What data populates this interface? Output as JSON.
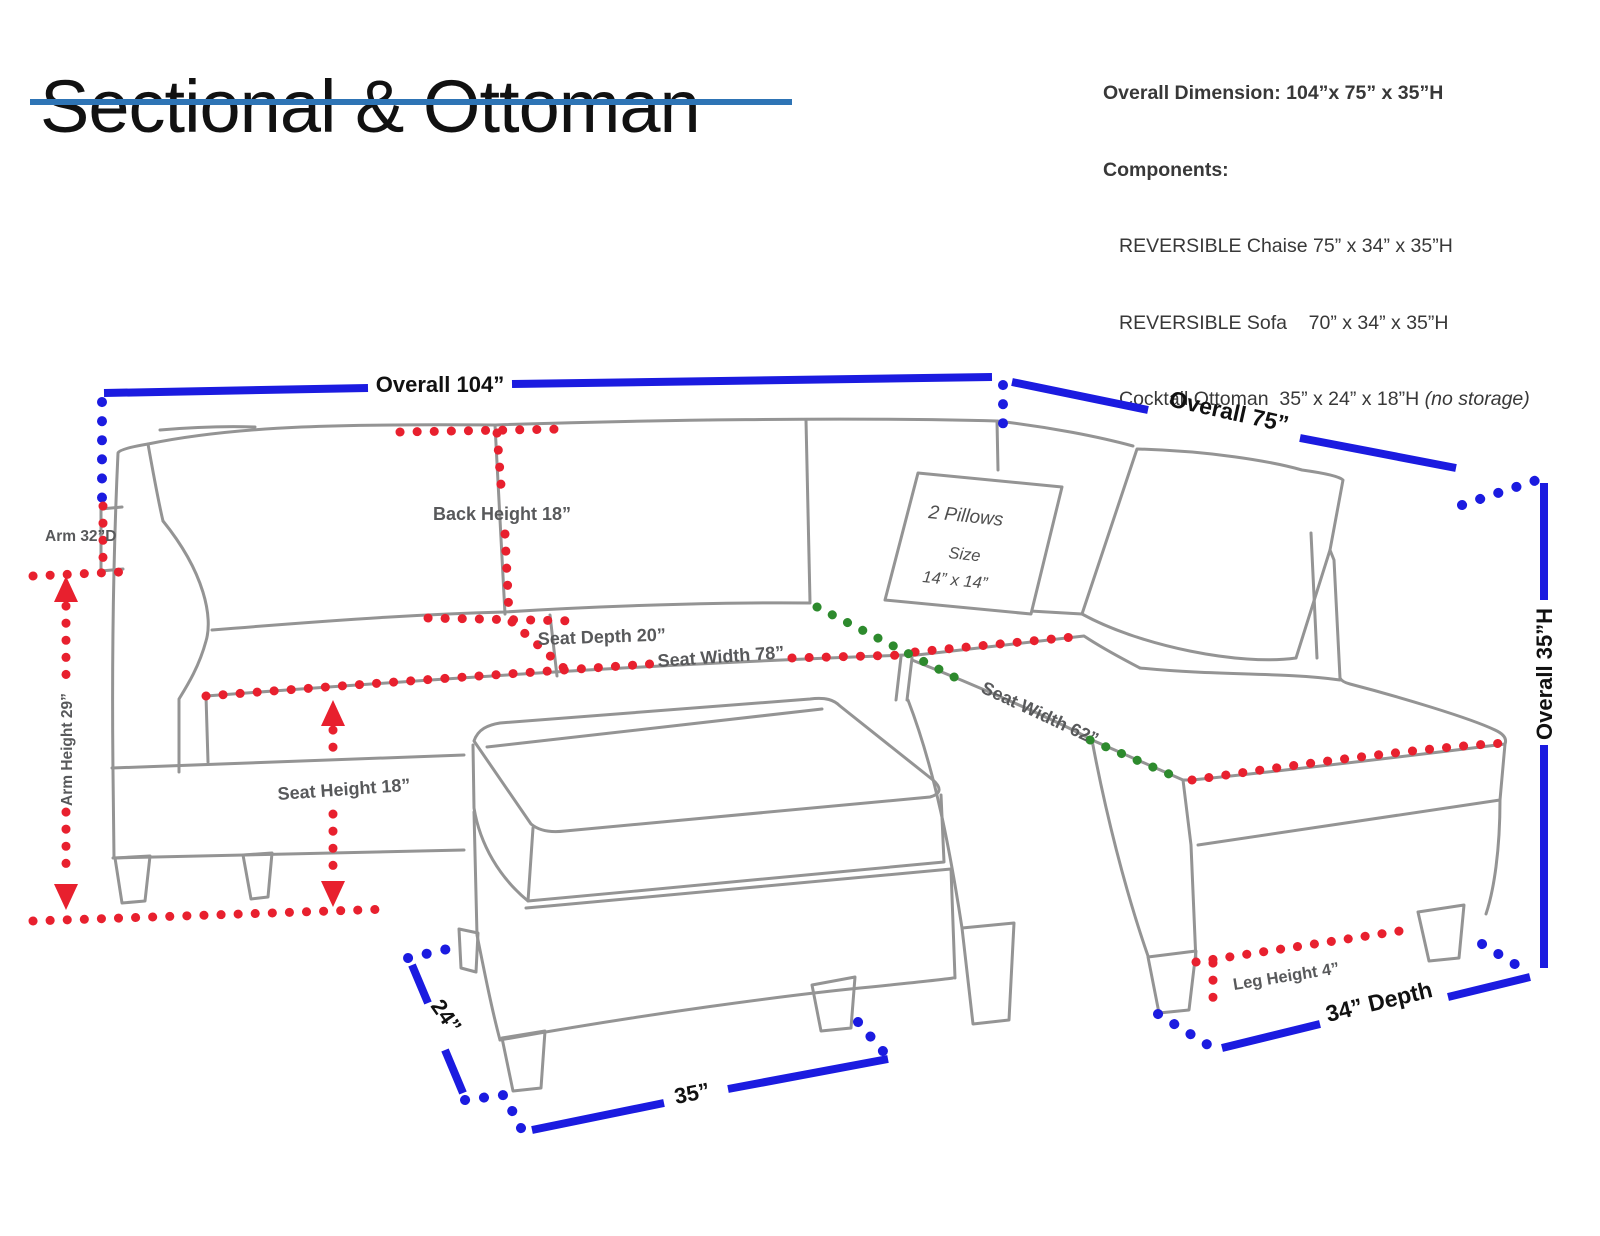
{
  "title": {
    "text": "Sectional & Ottoman"
  },
  "specs": {
    "overall": "Overall Dimension: 104”x 75” x 35”H",
    "components_label": "Components:",
    "items": [
      {
        "text": "REVERSIBLE Chaise 75” x 34” x 35”H",
        "note": ""
      },
      {
        "text": "REVERSIBLE Sofa    70” x 34” x 35”H",
        "note": ""
      },
      {
        "text": "Cocktail Ottoman  35” x 24” x 18”H ",
        "note": "(no storage)"
      }
    ]
  },
  "measurements": {
    "overall_width": "Overall  104”",
    "overall_depth": "Overall  75”",
    "overall_height": "Overall  35”H",
    "back_height": "Back Height 18”",
    "seat_depth": "Seat  Depth 20”",
    "seat_width_sofa": "Seat  Width 78”",
    "seat_width_chaise": "Seat Width 62”",
    "seat_height": "Seat Height 18”",
    "arm_depth": "Arm 32”D",
    "arm_height": "Arm Height 29”",
    "leg_height": "Leg Height 4”",
    "chaise_depth": "34” Depth",
    "ottoman_width": "35”",
    "ottoman_depth": "24”"
  },
  "pillow": {
    "line1": "2 Pillows",
    "line2": "Size",
    "line3": "14” x 14”"
  },
  "colors": {
    "dimension_blue": "#1b1be0",
    "dimension_red": "#e8202e",
    "dimension_green": "#2d8a2d",
    "outline_gray": "#949494",
    "label_gray": "#58595b",
    "title_underline": "#2e74b5"
  }
}
